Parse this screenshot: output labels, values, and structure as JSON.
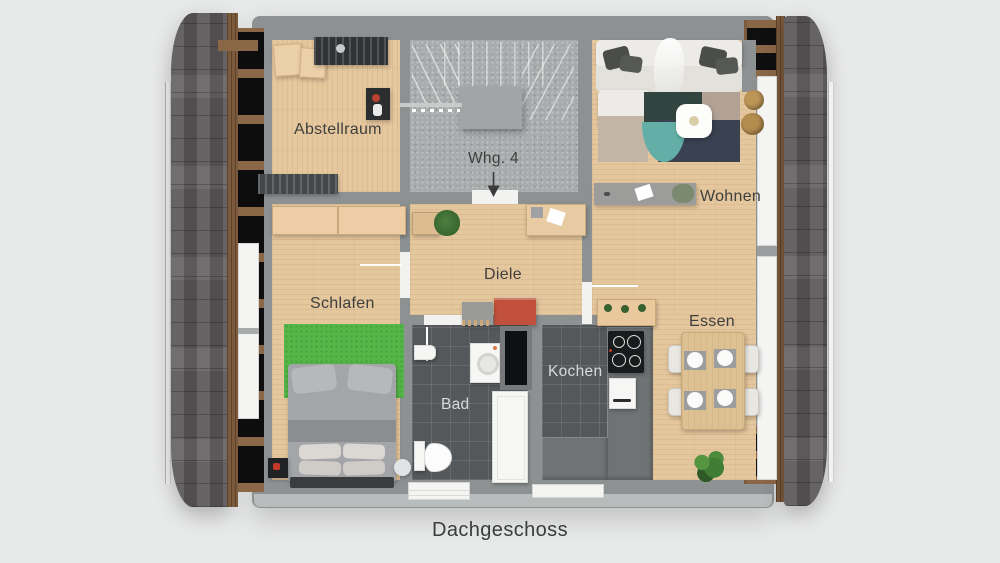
{
  "caption": "Dachgeschoss",
  "unit": {
    "label": "Whg. 4"
  },
  "rooms": {
    "abstellraum": {
      "label": "Abstellraum"
    },
    "wohnen": {
      "label": "Wohnen"
    },
    "schlafen": {
      "label": "Schlafen"
    },
    "diele": {
      "label": "Diele"
    },
    "bad": {
      "label": "Bad"
    },
    "kochen": {
      "label": "Kochen"
    },
    "essen": {
      "label": "Essen"
    }
  },
  "icons": {
    "entrance_arrow": "down-arrow"
  },
  "colors": {
    "background": "#e8e9e9",
    "wall": "#8d9192",
    "wood_floor": "#e5c79e",
    "stair_floor": "#a9acad",
    "tile_dark": "#55585b",
    "counter": "#6f7374",
    "roof_shingle": "#5d595a",
    "wood_beam": "#7b5a3d",
    "rug_green": "#55b747",
    "rug_teal": "#63afa7",
    "accent_red": "#c1513b",
    "label_dark": "#3e3f3f",
    "label_light": "#d8d9d9"
  }
}
